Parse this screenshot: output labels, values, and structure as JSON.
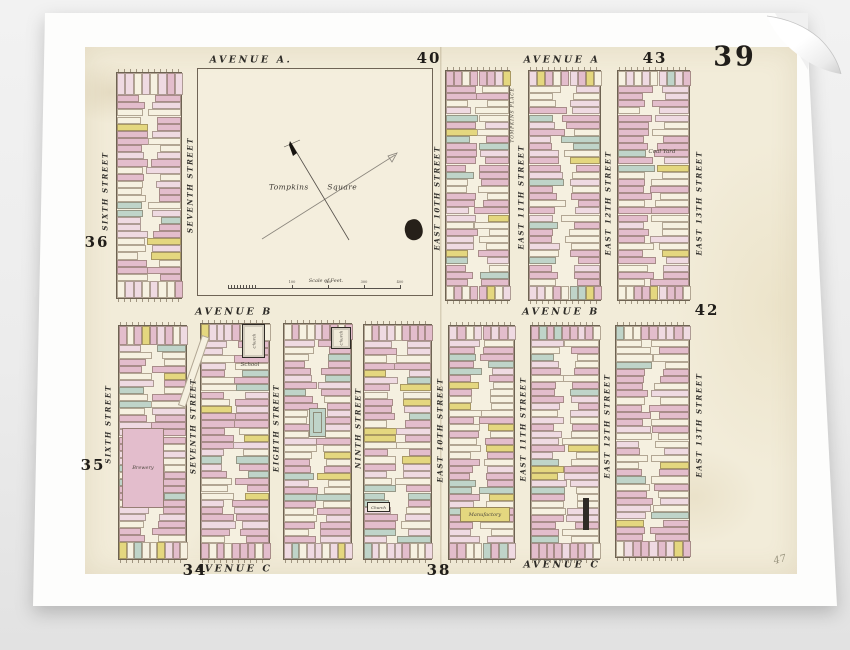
{
  "scene": {
    "background_color": "#ececec",
    "sheet_color": "#fdfdfc",
    "paper_color": "#f2ecd9"
  },
  "plate": {
    "number_large": "39",
    "handwritten_number": "47"
  },
  "map": {
    "avenues": [
      {
        "text": "AVENUE A.",
        "x": 251,
        "y": 60
      },
      {
        "text": "AVENUE A",
        "x": 562,
        "y": 60
      },
      {
        "text": "AVENUE B",
        "x": 234,
        "y": 312
      },
      {
        "text": "AVENUE B",
        "x": 561,
        "y": 312
      },
      {
        "text": "AVENUE C",
        "x": 234,
        "y": 569
      },
      {
        "text": "AVENUE C",
        "x": 562,
        "y": 565
      }
    ],
    "streets": [
      {
        "text": "SIXTH STREET",
        "x": 105,
        "y": 191
      },
      {
        "text": "SEVENTH STREET",
        "x": 190,
        "y": 185
      },
      {
        "text": "EAST 10TH STREET",
        "x": 437,
        "y": 198
      },
      {
        "text": "EAST 11TH STREET",
        "x": 521,
        "y": 197
      },
      {
        "text": "EAST 12TH STREET",
        "x": 608,
        "y": 203
      },
      {
        "text": "EAST 13TH STREET",
        "x": 699,
        "y": 203
      },
      {
        "text": "SIXTH STREET",
        "x": 108,
        "y": 424
      },
      {
        "text": "SEVENTH STREET",
        "x": 193,
        "y": 426
      },
      {
        "text": "EIGHTH STREET",
        "x": 276,
        "y": 428
      },
      {
        "text": "NINTH STREET",
        "x": 358,
        "y": 428
      },
      {
        "text": "EAST 10TH STREET",
        "x": 440,
        "y": 430
      },
      {
        "text": "EAST 11TH STREET",
        "x": 523,
        "y": 429
      },
      {
        "text": "EAST 12TH STREET",
        "x": 607,
        "y": 426
      },
      {
        "text": "EAST 13TH STREET",
        "x": 699,
        "y": 425
      }
    ],
    "plates": [
      {
        "text": "40",
        "x": 429,
        "y": 58,
        "size": 15
      },
      {
        "text": "43",
        "x": 655,
        "y": 58,
        "size": 15
      },
      {
        "text": "39",
        "x": 735,
        "y": 57,
        "size": 27,
        "big": true
      },
      {
        "text": "36",
        "x": 97,
        "y": 242,
        "size": 15
      },
      {
        "text": "42",
        "x": 707,
        "y": 310,
        "size": 15
      },
      {
        "text": "35",
        "x": 93,
        "y": 465,
        "size": 15
      },
      {
        "text": "34",
        "x": 195,
        "y": 570,
        "size": 15
      },
      {
        "text": "38",
        "x": 439,
        "y": 570,
        "size": 15
      },
      {
        "text": "47",
        "x": 780,
        "y": 560,
        "size": 10,
        "handwritten": true
      }
    ],
    "tompkins_square": {
      "name": "Tompkins Square",
      "scale_label": "Scale of Feet.",
      "scale_ticks": [
        "100",
        "200",
        "300",
        "400"
      ],
      "x": 197,
      "y": 68,
      "w": 236,
      "h": 228
    },
    "features": [
      {
        "type": "dark_building",
        "x": 242,
        "y": 324,
        "w": 23,
        "h": 34,
        "label": "Church"
      },
      {
        "type": "script_label",
        "x": 250,
        "y": 365,
        "text": "School"
      },
      {
        "type": "dark_building",
        "x": 331,
        "y": 327,
        "w": 20,
        "h": 22,
        "label": "Church"
      },
      {
        "type": "dark_box",
        "x": 367,
        "y": 502,
        "w": 23,
        "h": 10,
        "label": "Church"
      },
      {
        "type": "tinted_building",
        "color": "pink",
        "x": 122,
        "y": 428,
        "w": 42,
        "h": 80,
        "label": "Brewery"
      },
      {
        "type": "tinted_building",
        "color": "yellow",
        "x": 460,
        "y": 507,
        "w": 50,
        "h": 15,
        "label": "Manufactory"
      },
      {
        "type": "script_label",
        "x": 662,
        "y": 152,
        "text": "Coal Yard"
      },
      {
        "type": "vertical_label",
        "x": 513,
        "y": 115,
        "text": "TOMPKINS PLACE"
      },
      {
        "type": "dark_bar",
        "x": 583,
        "y": 498,
        "w": 6,
        "h": 32
      },
      {
        "type": "green_building",
        "x": 309,
        "y": 408,
        "w": 17,
        "h": 29
      },
      {
        "type": "lane",
        "x": 202,
        "y": 335,
        "w": 8,
        "h": 74,
        "angle": 19
      }
    ],
    "blocks": [
      {
        "x": 116,
        "y": 72,
        "w": 66,
        "h": 227,
        "seed": 11,
        "top": 22,
        "bottom": 17
      },
      {
        "x": 445,
        "y": 70,
        "w": 65,
        "h": 231,
        "seed": 23,
        "top": 15,
        "bottom": 14
      },
      {
        "x": 528,
        "y": 70,
        "w": 73,
        "h": 231,
        "seed": 37,
        "top": 15,
        "bottom": 14
      },
      {
        "x": 617,
        "y": 70,
        "w": 73,
        "h": 231,
        "seed": 41,
        "top": 15,
        "bottom": 14
      },
      {
        "x": 118,
        "y": 325,
        "w": 69,
        "h": 235,
        "seed": 53,
        "top": 19,
        "bottom": 17
      },
      {
        "x": 200,
        "y": 323,
        "w": 70,
        "h": 237,
        "seed": 67,
        "top": 17,
        "bottom": 16
      },
      {
        "x": 283,
        "y": 323,
        "w": 69,
        "h": 237,
        "seed": 71,
        "top": 16,
        "bottom": 16
      },
      {
        "x": 363,
        "y": 324,
        "w": 69,
        "h": 236,
        "seed": 83,
        "top": 16,
        "bottom": 16
      },
      {
        "x": 448,
        "y": 325,
        "w": 67,
        "h": 235,
        "seed": 97,
        "top": 14,
        "bottom": 16
      },
      {
        "x": 530,
        "y": 325,
        "w": 70,
        "h": 235,
        "seed": 103,
        "top": 14,
        "bottom": 16
      },
      {
        "x": 615,
        "y": 325,
        "w": 75,
        "h": 233,
        "seed": 109,
        "top": 14,
        "bottom": 16
      }
    ],
    "palette": {
      "pink": "#e3bdcc",
      "light_pink": "#efdae2",
      "cream": "#f6f1e1",
      "green": "#bfd4c9",
      "yellow": "#e4d77f",
      "stroke": "rgba(110,92,70,0.5)",
      "block_border": "#6e6352",
      "ink": "#2e2b28"
    }
  }
}
